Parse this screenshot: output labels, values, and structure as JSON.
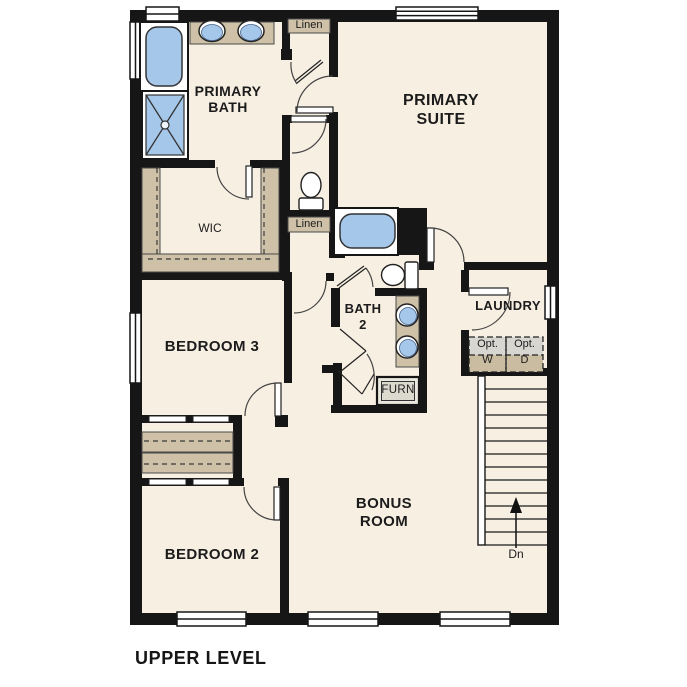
{
  "title": "UPPER LEVEL",
  "colors": {
    "wall": "#161616",
    "floor": "#f7efe2",
    "counter_tan": "#cec1a7",
    "fixture_blue": "#a5c7e9",
    "optional_gray": "#d8d6d1",
    "window_white": "#ffffff"
  },
  "rooms": {
    "primary_bath": {
      "line1": "PRIMARY",
      "line2": "BATH"
    },
    "primary_suite": {
      "line1": "PRIMARY",
      "line2": "SUITE"
    },
    "wic": {
      "label": "WIC"
    },
    "bedroom3": {
      "label": "BEDROOM 3"
    },
    "bath2": {
      "line1": "BATH",
      "line2": "2"
    },
    "laundry": {
      "label": "LAUNDRY"
    },
    "bedroom2": {
      "label": "BEDROOM 2"
    },
    "bonus_room": {
      "line1": "BONUS",
      "line2": "ROOM"
    }
  },
  "closets": {
    "linen_upper": "Linen",
    "linen_lower": "Linen"
  },
  "fixtures": {
    "furnace": "FURN"
  },
  "laundry_options": {
    "washer": {
      "line1": "Opt.",
      "line2": "W"
    },
    "dryer": {
      "line1": "Opt.",
      "line2": "D"
    }
  },
  "stairs": {
    "direction_label": "Dn"
  }
}
